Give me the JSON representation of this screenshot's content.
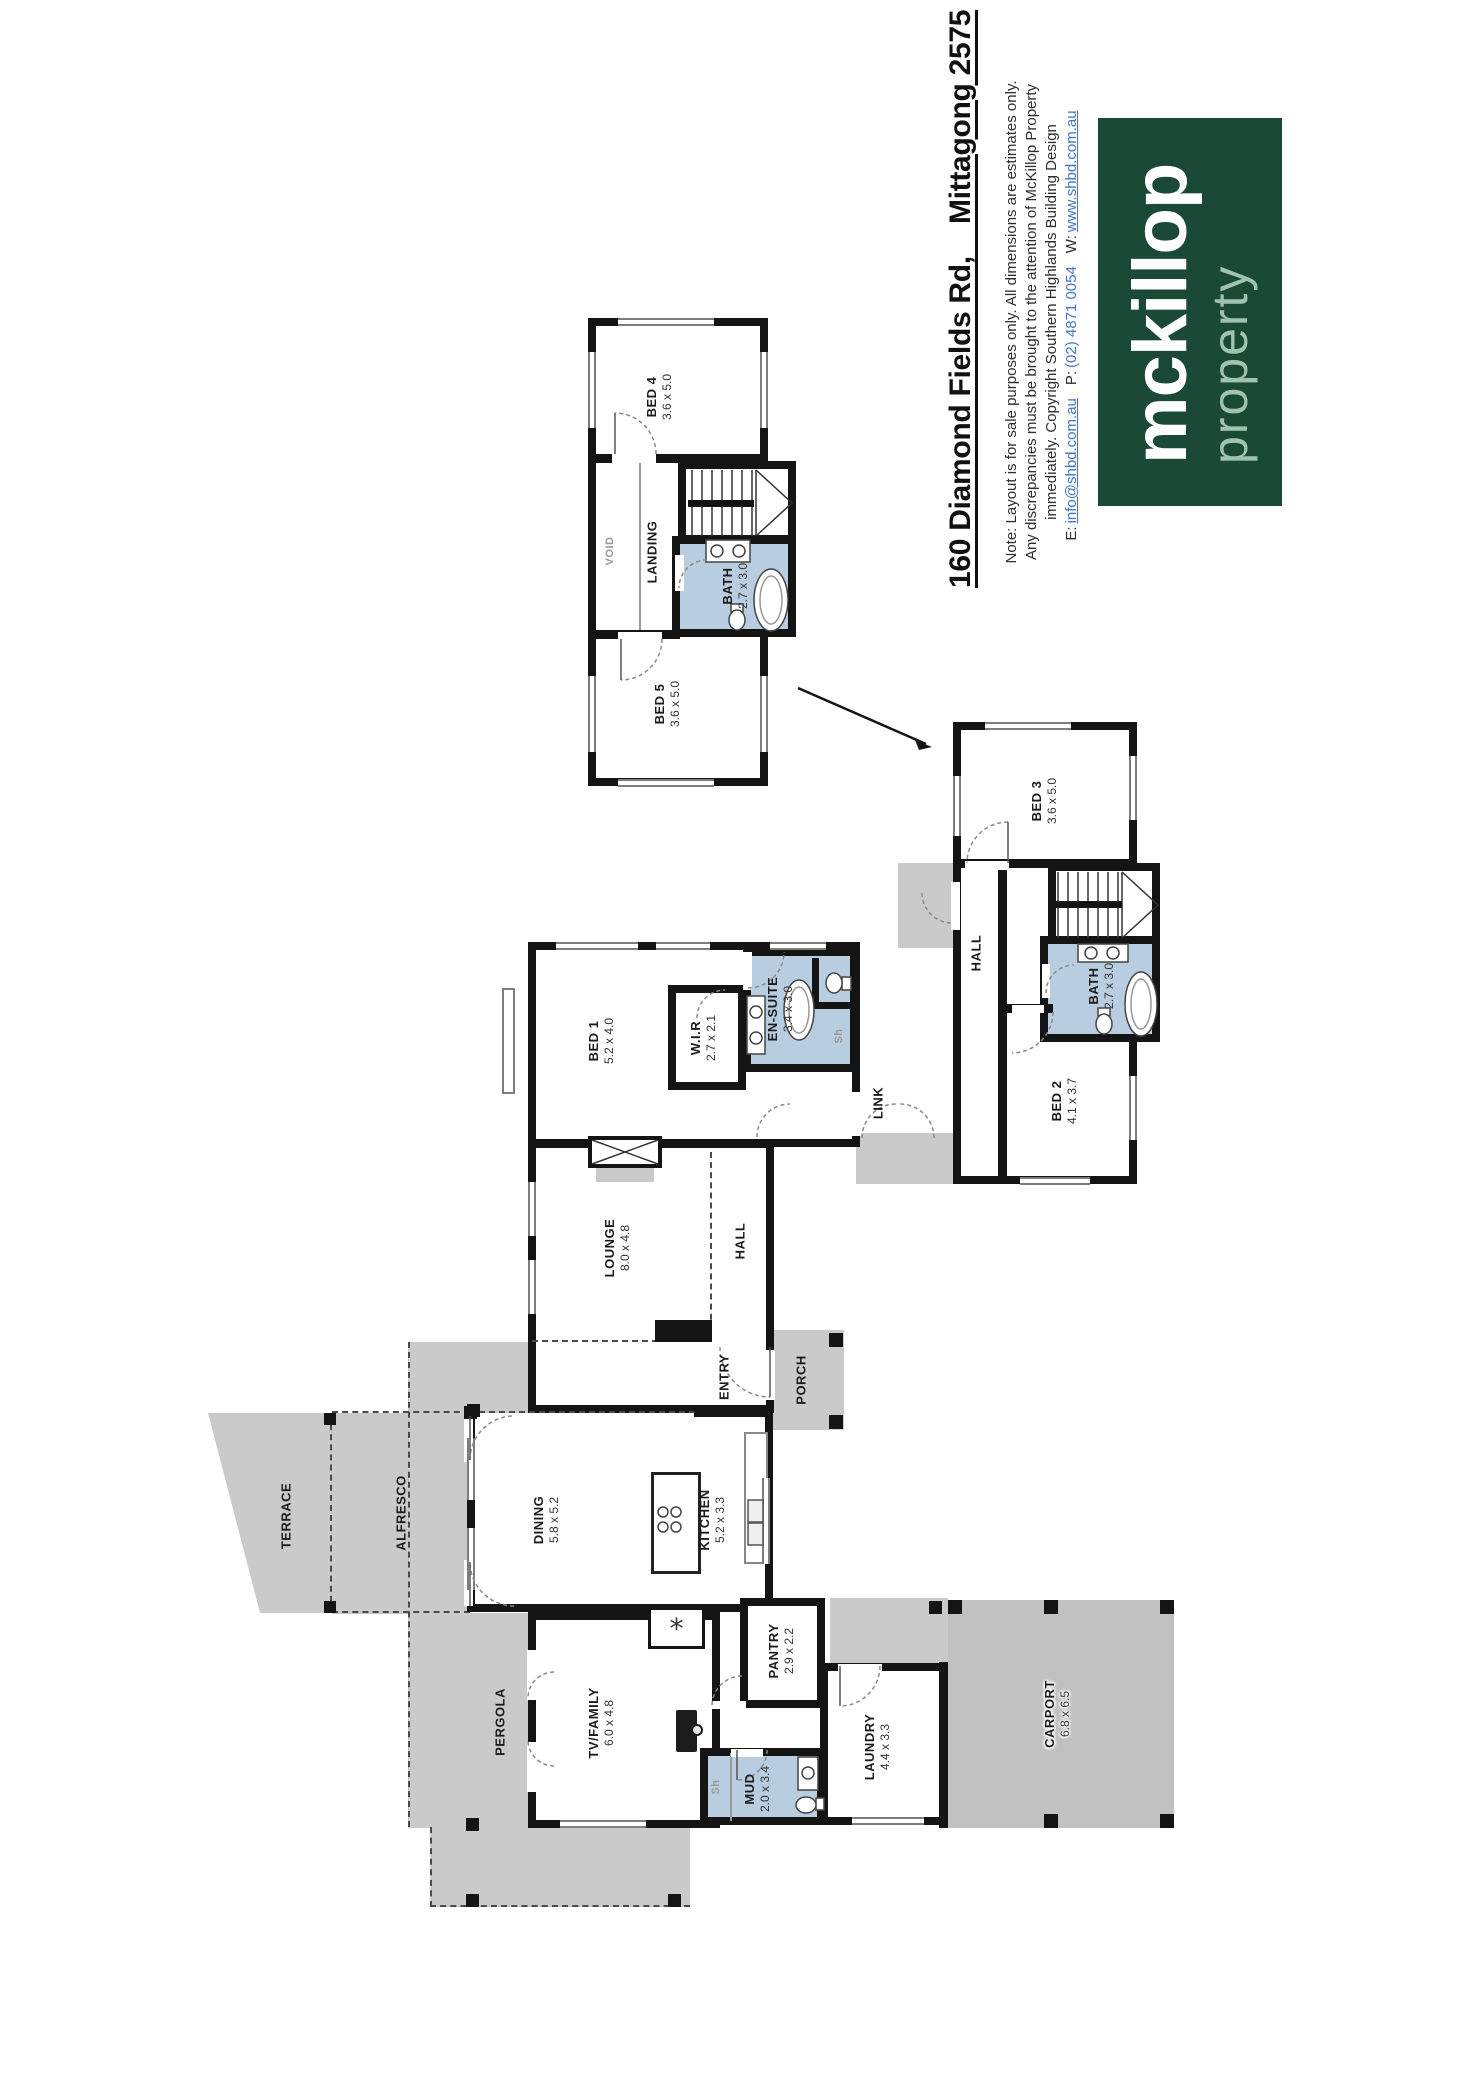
{
  "header": {
    "title": "160 Diamond Fields Rd,    Mittagong 2575",
    "notes": [
      "Note: Layout is for sale purposes only.  All dimensions are estimates only.",
      "Any discrepancies must be brought to the attention of McKillop Property",
      "immediately.  Copyright Southern Highlands Building Design"
    ],
    "contact": {
      "email_label": "E:",
      "email": "info@shbd.com.au",
      "phone_label": "P:",
      "phone": "(02) 4871 0054",
      "web_label": "W:",
      "web": "www.shbd.com.au"
    },
    "logo": {
      "name": "mckillop",
      "tagline": "property"
    }
  },
  "colors": {
    "logo_bg": "#1a4a35",
    "logo_tagline": "#9fc3ae",
    "wet_area": "#b9cde0",
    "outdoor": "#cacaca",
    "outdoor_dark": "#c1c1c1",
    "wall": "#141414",
    "link_blue": "#4472c4"
  },
  "rooms": {
    "bed4": {
      "label": "BED 4",
      "dims": "3.6 x 5.0"
    },
    "bed5": {
      "label": "BED 5",
      "dims": "3.6 x 5.0"
    },
    "bath_upper": {
      "label": "BATH",
      "dims": "2.7 x 3.0"
    },
    "landing": {
      "label": "LANDING"
    },
    "void": {
      "label": "VOID"
    },
    "bed3": {
      "label": "BED 3",
      "dims": "3.6 x 5.0"
    },
    "bed2": {
      "label": "BED 2",
      "dims": "4.1 x 3.7"
    },
    "bath_wing": {
      "label": "BATH",
      "dims": "2.7 x 3.0"
    },
    "hall_wing": {
      "label": "HALL"
    },
    "bed1": {
      "label": "BED 1",
      "dims": "5.2 x 4.0"
    },
    "wir": {
      "label": "W.I.R",
      "dims": "2.7 x 2.1"
    },
    "ensuite": {
      "label": "EN-SUITE",
      "dims": "3.4 x 3.0"
    },
    "link": {
      "label": "LINK"
    },
    "lounge": {
      "label": "LOUNGE",
      "dims": "8.0 x 4.8"
    },
    "hall_main": {
      "label": "HALL"
    },
    "entry": {
      "label": "ENTRY"
    },
    "porch": {
      "label": "PORCH"
    },
    "dining": {
      "label": "DINING",
      "dims": "5.8 x 5.2"
    },
    "kitchen": {
      "label": "KITCHEN",
      "dims": "5.2 x 3.3"
    },
    "pantry": {
      "label": "PANTRY",
      "dims": "2.9 x 2.2"
    },
    "tv_family": {
      "label": "TV/FAMILY",
      "dims": "6.0 x 4.8"
    },
    "laundry": {
      "label": "LAUNDRY",
      "dims": "4.4 x 3.3"
    },
    "mud": {
      "label": "MUD",
      "dims": "2.0 x 3.4"
    },
    "alfresco": {
      "label": "ALFRESCO"
    },
    "terrace": {
      "label": "TERRACE"
    },
    "pergola": {
      "label": "PERGOLA"
    },
    "carport": {
      "label": "CARPORT",
      "dims": "6.8 x 6.5"
    }
  },
  "labels": {
    "shower": "Sh",
    "fireplace_symbol": "*"
  }
}
